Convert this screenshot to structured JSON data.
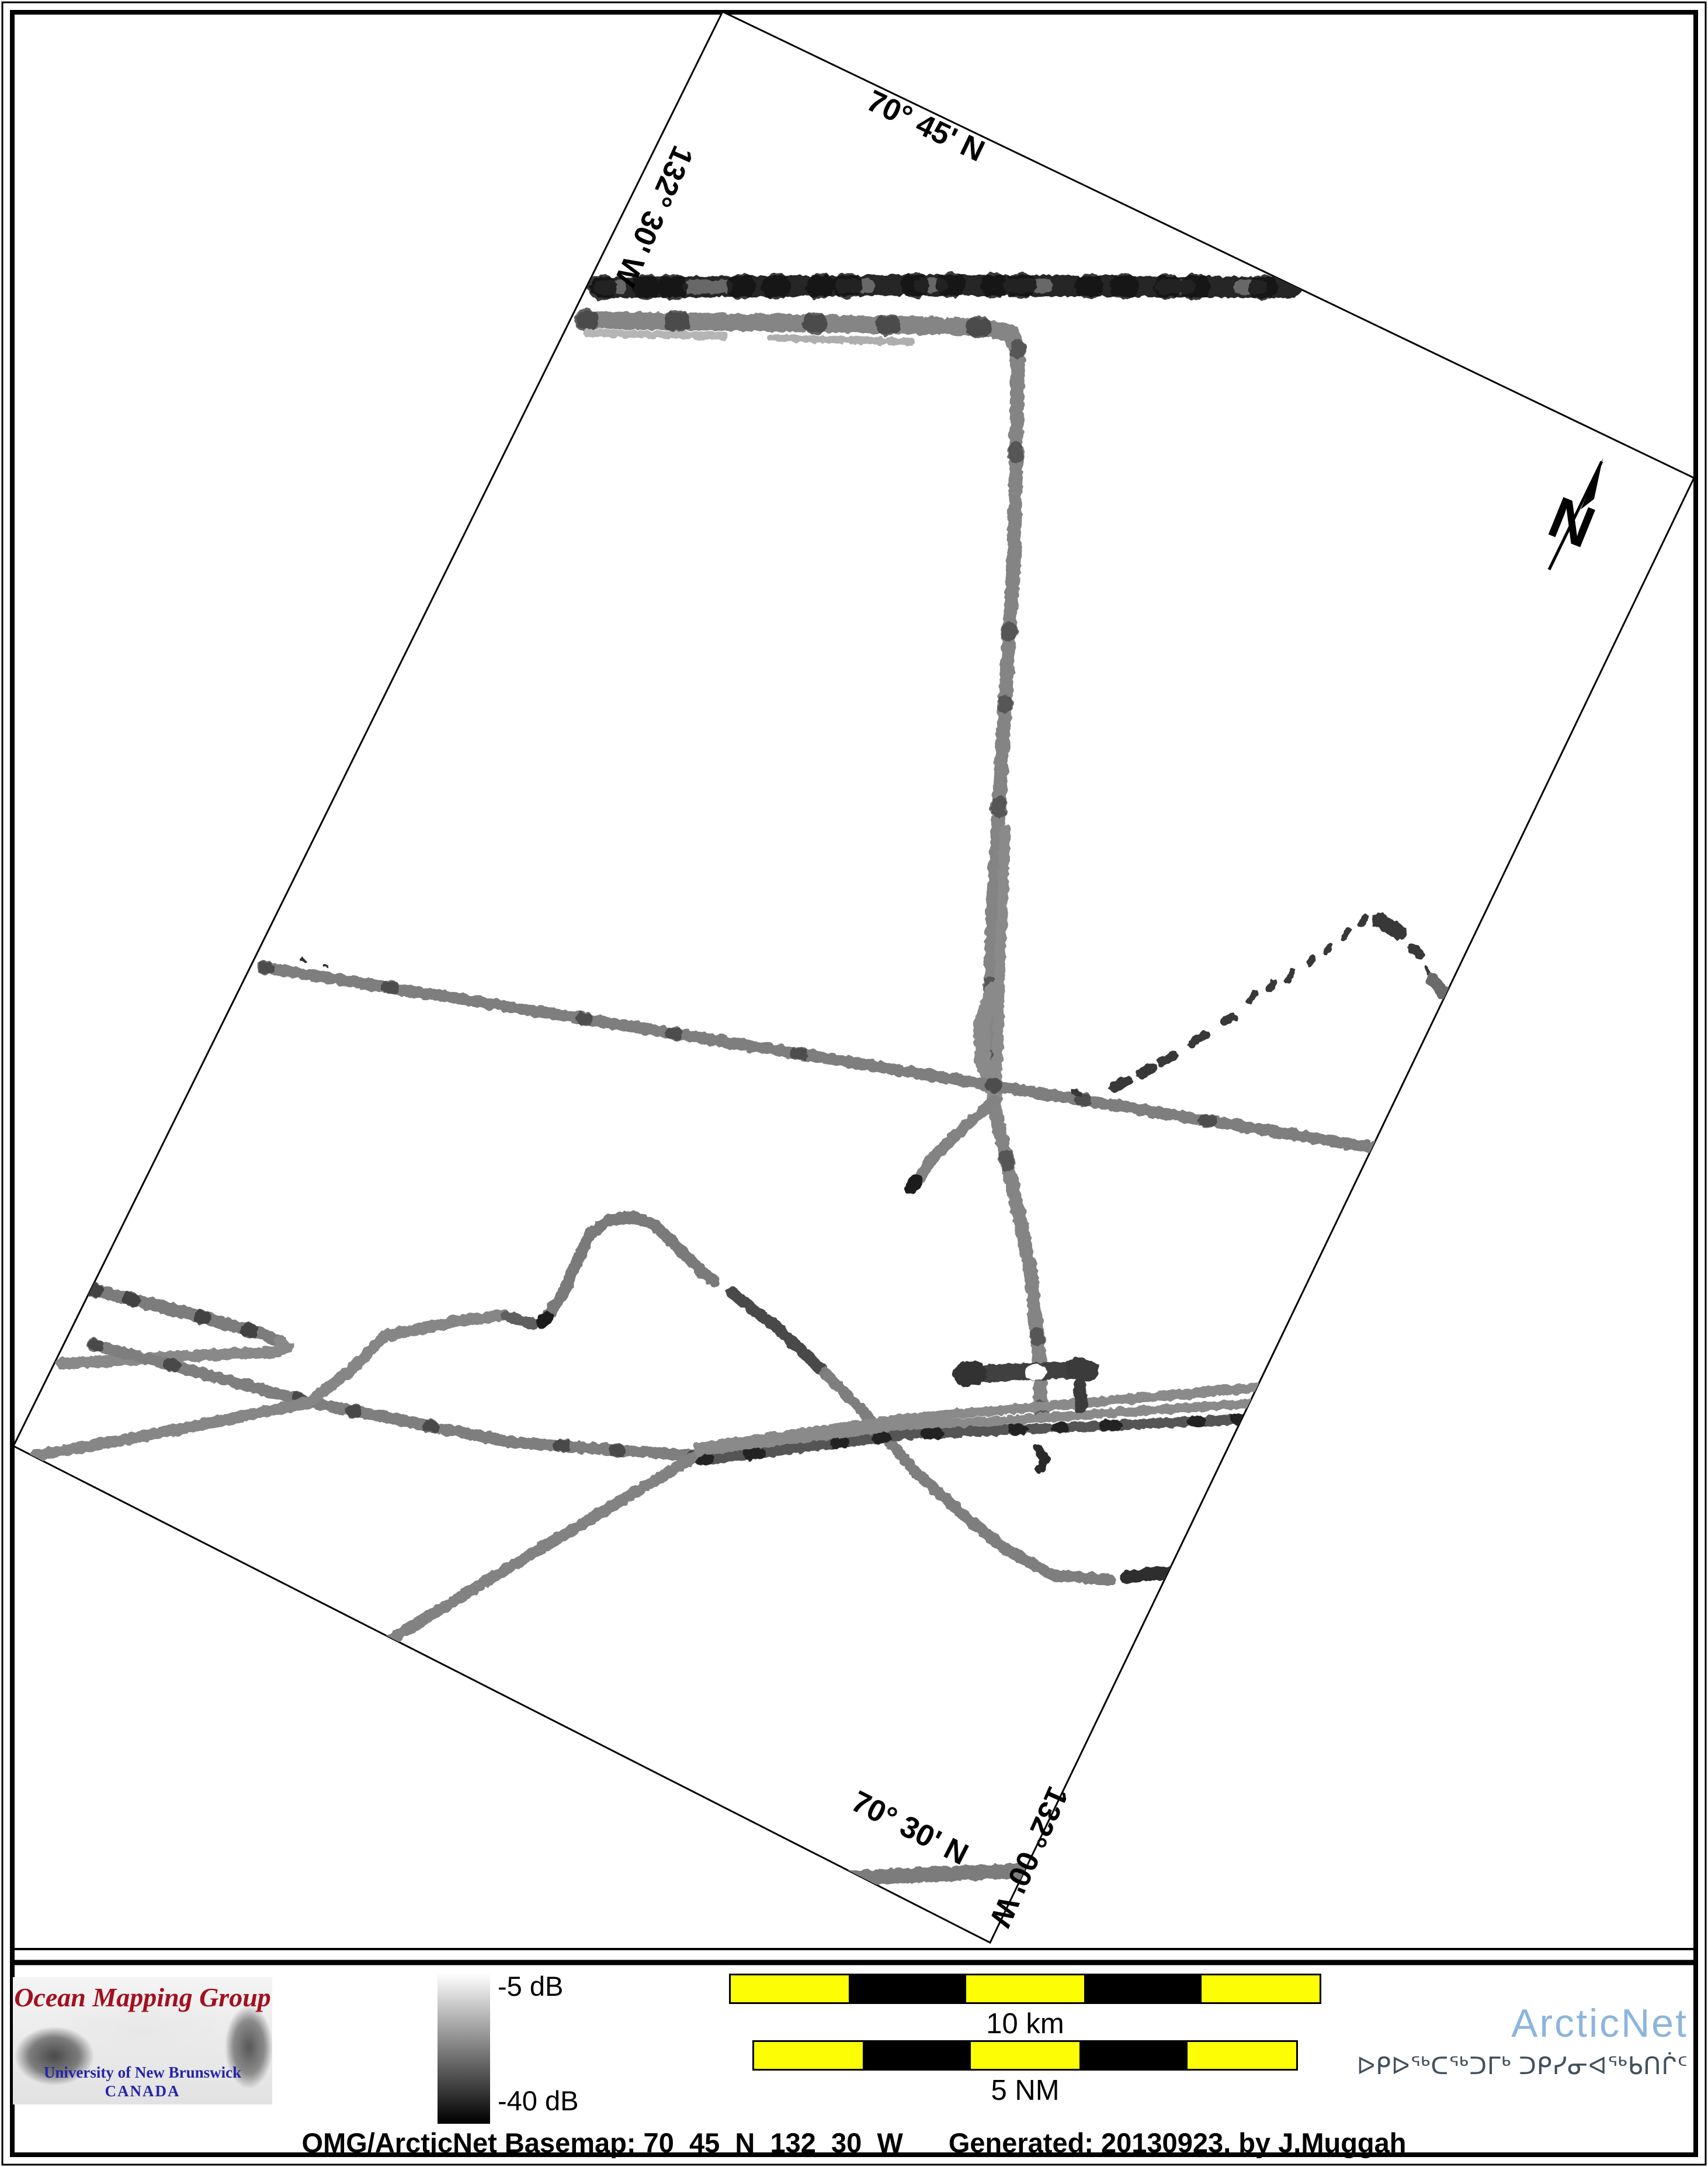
{
  "map": {
    "labels": {
      "lat_top": "70° 45' N",
      "lon_left": "132° 30' W",
      "lat_bottom": "70° 30' N",
      "lon_right": "132° 00' W"
    },
    "north_arrow": {
      "letter": "N"
    },
    "tracks": [
      {
        "name": "top-dark-band",
        "pts": [
          [
            1028,
            492
          ],
          [
            1620,
            488
          ],
          [
            2212,
            492
          ]
        ],
        "w": 36,
        "c": "#282828"
      },
      {
        "name": "top-dark-band-light-patches",
        "pts": [
          [
            1028,
            492
          ],
          [
            1620,
            488
          ],
          [
            2212,
            492
          ]
        ],
        "w": 24,
        "c": "#6e6e6e",
        "dash": "34 120 60 200 44 90",
        "o": 0.9
      },
      {
        "name": "top-dark-band-frays",
        "pts": [
          [
            1028,
            492
          ],
          [
            1620,
            488
          ],
          [
            2212,
            492
          ]
        ],
        "w": 44,
        "c": "#161616",
        "dash": "6 70 4 40 8 110 5 55",
        "o": 0.85
      },
      {
        "name": "top-gray-band",
        "pts": [
          [
            1002,
            548
          ],
          [
            1380,
            553
          ],
          [
            1688,
            560
          ],
          [
            1730,
            570
          ],
          [
            1743,
            600
          ]
        ],
        "w": 30,
        "c": "#858585"
      },
      {
        "name": "top-gray-band-ticks",
        "pts": [
          [
            1002,
            548
          ],
          [
            1380,
            553
          ],
          [
            1688,
            560
          ]
        ],
        "w": 38,
        "c": "#3c3c3c",
        "dash": "4 150 7 230 5 120",
        "o": 0.8
      },
      {
        "name": "top-gray-fringe-1",
        "pts": [
          [
            1005,
            570
          ],
          [
            1240,
            575
          ]
        ],
        "w": 13,
        "c": "#b5b5b5"
      },
      {
        "name": "top-gray-fringe-2",
        "pts": [
          [
            1320,
            578
          ],
          [
            1560,
            585
          ]
        ],
        "w": 13,
        "c": "#aeaeae"
      },
      {
        "name": "vertical-track",
        "pts": [
          [
            1743,
            595
          ],
          [
            1736,
            950
          ],
          [
            1718,
            1250
          ],
          [
            1700,
            1550
          ],
          [
            1694,
            1780
          ],
          [
            1704,
            1905
          ],
          [
            1734,
            2030
          ],
          [
            1765,
            2180
          ],
          [
            1779,
            2320
          ],
          [
            1782,
            2420
          ]
        ],
        "w": 24,
        "c": "#848484"
      },
      {
        "name": "vertical-track-ticks",
        "pts": [
          [
            1743,
            595
          ],
          [
            1736,
            950
          ],
          [
            1718,
            1250
          ],
          [
            1700,
            1550
          ],
          [
            1694,
            1780
          ],
          [
            1704,
            1905
          ],
          [
            1734,
            2030
          ],
          [
            1765,
            2180
          ],
          [
            1779,
            2320
          ],
          [
            1782,
            2420
          ]
        ],
        "w": 28,
        "c": "#454545",
        "dash": "5 170 9 300 4 120",
        "o": 0.7
      },
      {
        "name": "vertical-strand-2",
        "pts": [
          [
            1721,
            1420
          ],
          [
            1712,
            1640
          ],
          [
            1706,
            1865
          ]
        ],
        "w": 18,
        "c": "#8a8a8a"
      },
      {
        "name": "vertical-bulge",
        "pts": [
          [
            1700,
            1695
          ],
          [
            1680,
            1755
          ],
          [
            1683,
            1815
          ],
          [
            1702,
            1868
          ]
        ],
        "w": 28,
        "c": "#8a8a8a"
      },
      {
        "name": "branch-downleft",
        "pts": [
          [
            1702,
            1885
          ],
          [
            1652,
            1928
          ],
          [
            1598,
            1980
          ],
          [
            1572,
            2018
          ]
        ],
        "w": 20,
        "c": "#838383"
      },
      {
        "name": "branch-tip",
        "pts": [
          [
            1568,
            2022
          ],
          [
            1560,
            2032
          ]
        ],
        "w": 24,
        "c": "#1f1f1f"
      },
      {
        "name": "long-diagonal",
        "pts": [
          [
            452,
            1656
          ],
          [
            1100,
            1760
          ],
          [
            1700,
            1858
          ],
          [
            2349,
            1964
          ]
        ],
        "w": 20,
        "c": "#7e7e7e"
      },
      {
        "name": "long-diagonal-ticks",
        "pts": [
          [
            452,
            1656
          ],
          [
            1100,
            1760
          ],
          [
            1700,
            1858
          ],
          [
            2349,
            1964
          ]
        ],
        "w": 24,
        "c": "#3a3a3a",
        "dash": "5 210 8 330 6 150",
        "o": 0.7
      },
      {
        "name": "hairpin-upper",
        "pts": [
          [
            160,
            2208
          ],
          [
            330,
            2250
          ],
          [
            452,
            2284
          ],
          [
            480,
            2296
          ]
        ],
        "w": 22,
        "c": "#7c7c7c"
      },
      {
        "name": "hairpin-upper-ticks",
        "pts": [
          [
            160,
            2208
          ],
          [
            330,
            2250
          ],
          [
            452,
            2284
          ]
        ],
        "w": 26,
        "c": "#2f2f2f",
        "dash": "4 60 6 120 3 80",
        "o": 0.75
      },
      {
        "name": "hairpin-lower",
        "pts": [
          [
            480,
            2296
          ],
          [
            492,
            2306
          ],
          [
            474,
            2314
          ],
          [
            300,
            2322
          ],
          [
            106,
            2334
          ]
        ],
        "w": 20,
        "c": "#898989"
      },
      {
        "name": "line-a",
        "pts": [
          [
            162,
            2302
          ],
          [
            530,
            2400
          ],
          [
            872,
            2468
          ],
          [
            1030,
            2480
          ],
          [
            1192,
            2492
          ]
        ],
        "w": 20,
        "c": "#7e7e7e"
      },
      {
        "name": "line-a-ticks",
        "pts": [
          [
            162,
            2302
          ],
          [
            530,
            2400
          ],
          [
            872,
            2468
          ],
          [
            1030,
            2480
          ],
          [
            1192,
            2492
          ]
        ],
        "w": 24,
        "c": "#333333",
        "dash": "4 130 7 220 5 90",
        "o": 0.7
      },
      {
        "name": "line-b",
        "pts": [
          [
            60,
            2492
          ],
          [
            300,
            2448
          ],
          [
            530,
            2400
          ],
          [
            600,
            2345
          ],
          [
            660,
            2286
          ],
          [
            780,
            2262
          ],
          [
            864,
            2251
          ]
        ],
        "w": 20,
        "c": "#868686"
      },
      {
        "name": "line-b-dash",
        "pts": [
          [
            868,
            2253
          ],
          [
            914,
            2266
          ]
        ],
        "w": 20,
        "c": "#5f5f5f"
      },
      {
        "name": "hill-track",
        "pts": [
          [
            930,
            2262
          ],
          [
            962,
            2218
          ],
          [
            988,
            2160
          ],
          [
            1010,
            2112
          ],
          [
            1042,
            2088
          ],
          [
            1085,
            2083
          ],
          [
            1122,
            2097
          ],
          [
            1165,
            2140
          ],
          [
            1205,
            2180
          ],
          [
            1222,
            2194
          ]
        ],
        "w": 20,
        "c": "#7a7a7a"
      },
      {
        "name": "hill-start-tip",
        "pts": [
          [
            928,
            2262
          ],
          [
            936,
            2255
          ]
        ],
        "w": 22,
        "c": "#1f1f1f"
      },
      {
        "name": "hill-cont-dark",
        "pts": [
          [
            1252,
            2212
          ],
          [
            1330,
            2272
          ],
          [
            1412,
            2350
          ]
        ],
        "w": 20,
        "c": "#4a4a4a"
      },
      {
        "name": "hill-cont",
        "pts": [
          [
            1412,
            2350
          ],
          [
            1500,
            2440
          ],
          [
            1568,
            2520
          ],
          [
            1648,
            2592
          ],
          [
            1722,
            2652
          ],
          [
            1802,
            2696
          ],
          [
            1900,
            2704
          ]
        ],
        "w": 20,
        "c": "#7e7e7e"
      },
      {
        "name": "junction-branch",
        "pts": [
          [
            1192,
            2492
          ],
          [
            1000,
            2606
          ],
          [
            800,
            2726
          ],
          [
            662,
            2810
          ]
        ],
        "w": 20,
        "c": "#828282"
      },
      {
        "name": "bundle-strand-1",
        "pts": [
          [
            1196,
            2478
          ],
          [
            1550,
            2428
          ],
          [
            2152,
            2375
          ]
        ],
        "w": 17,
        "c": "#8a8a8a"
      },
      {
        "name": "bundle-strand-2",
        "pts": [
          [
            1198,
            2490
          ],
          [
            1550,
            2443
          ],
          [
            2139,
            2402
          ]
        ],
        "w": 16,
        "c": "#8a8a8a"
      },
      {
        "name": "bundle-strand-3",
        "pts": [
          [
            1200,
            2500
          ],
          [
            1550,
            2456
          ],
          [
            2126,
            2429
          ]
        ],
        "w": 17,
        "c": "#555555"
      },
      {
        "name": "bundle-strand-3-ticks",
        "pts": [
          [
            1200,
            2500
          ],
          [
            1550,
            2456
          ],
          [
            2126,
            2429
          ]
        ],
        "w": 19,
        "c": "#141414",
        "dash": "12 70 20 130 14 60",
        "o": 0.8
      },
      {
        "name": "t-bar",
        "pts": [
          [
            1658,
            2352
          ],
          [
            1782,
            2347
          ],
          [
            1858,
            2344
          ]
        ],
        "w": 30,
        "c": "#3f3f3f"
      },
      {
        "name": "t-bar-blob-left",
        "pts": [
          [
            1652,
            2352
          ],
          [
            1668,
            2350
          ]
        ],
        "w": 42,
        "c": "#333333"
      },
      {
        "name": "t-bar-blob-right",
        "pts": [
          [
            1844,
            2342
          ],
          [
            1862,
            2346
          ]
        ],
        "w": 38,
        "c": "#3a3a3a"
      },
      {
        "name": "t-bar-notch",
        "pts": [
          [
            1768,
            2349
          ],
          [
            1778,
            2348
          ]
        ],
        "w": 26,
        "c": "#ffffff"
      },
      {
        "name": "t-stub",
        "pts": [
          [
            1848,
            2372
          ],
          [
            1851,
            2408
          ]
        ],
        "w": 22,
        "c": "#3a3a3a"
      },
      {
        "name": "bundle-squiggle",
        "pts": [
          [
            1778,
            2480
          ],
          [
            1790,
            2498
          ],
          [
            1780,
            2515
          ]
        ],
        "w": 16,
        "c": "#2c2c2c"
      },
      {
        "name": "corner-line",
        "pts": [
          [
            1424,
            3216
          ],
          [
            1600,
            3208
          ],
          [
            1758,
            3202
          ]
        ],
        "w": 26,
        "c": "#7b7b7b"
      },
      {
        "name": "dark-short-segment",
        "pts": [
          [
            1928,
            2700
          ],
          [
            1980,
            2693
          ],
          [
            2042,
            2688
          ]
        ],
        "w": 22,
        "c": "#2d2d2d"
      },
      {
        "name": "dash-arc-01",
        "pts": [
          [
            1838,
            1868
          ],
          [
            1848,
            1872
          ]
        ],
        "w": 10,
        "c": "#383838"
      },
      {
        "name": "dash-arc-02",
        "pts": [
          [
            1908,
            1860
          ],
          [
            1930,
            1850
          ]
        ],
        "w": 18,
        "c": "#383838"
      },
      {
        "name": "dash-arc-03",
        "pts": [
          [
            1952,
            1838
          ],
          [
            1972,
            1828
          ]
        ],
        "w": 18,
        "c": "#383838"
      },
      {
        "name": "dash-arc-04",
        "pts": [
          [
            1988,
            1818
          ],
          [
            2010,
            1806
          ]
        ],
        "w": 16,
        "c": "#383838"
      },
      {
        "name": "dash-arc-05",
        "pts": [
          [
            2040,
            1786
          ],
          [
            2062,
            1772
          ]
        ],
        "w": 16,
        "c": "#383838"
      },
      {
        "name": "dash-arc-06",
        "pts": [
          [
            2096,
            1748
          ],
          [
            2112,
            1740
          ]
        ],
        "w": 14,
        "c": "#383838"
      },
      {
        "name": "dash-arc-07",
        "pts": [
          [
            2140,
            1712
          ],
          [
            2148,
            1700
          ]
        ],
        "w": 12,
        "c": "#383838"
      },
      {
        "name": "dash-arc-08",
        "pts": [
          [
            2172,
            1694
          ],
          [
            2180,
            1682
          ]
        ],
        "w": 12,
        "c": "#383838"
      },
      {
        "name": "dash-arc-09",
        "pts": [
          [
            2204,
            1678
          ],
          [
            2212,
            1664
          ]
        ],
        "w": 12,
        "c": "#383838"
      },
      {
        "name": "dash-arc-10",
        "pts": [
          [
            2242,
            1650
          ],
          [
            2248,
            1638
          ]
        ],
        "w": 10,
        "c": "#383838"
      },
      {
        "name": "dash-arc-11",
        "pts": [
          [
            2270,
            1630
          ],
          [
            2276,
            1618
          ]
        ],
        "w": 10,
        "c": "#383838"
      },
      {
        "name": "dash-arc-12",
        "pts": [
          [
            2300,
            1606
          ],
          [
            2308,
            1592
          ]
        ],
        "w": 10,
        "c": "#383838"
      },
      {
        "name": "dash-arc-13",
        "pts": [
          [
            2330,
            1582
          ],
          [
            2338,
            1568
          ]
        ],
        "w": 10,
        "c": "#383838"
      },
      {
        "name": "dash-arc-14",
        "pts": [
          [
            2362,
            1576
          ],
          [
            2396,
            1596
          ]
        ],
        "w": 26,
        "c": "#383838"
      },
      {
        "name": "dash-arc-15",
        "pts": [
          [
            2418,
            1622
          ],
          [
            2430,
            1634
          ]
        ],
        "w": 16,
        "c": "#383838"
      },
      {
        "name": "dash-arc-16",
        "pts": [
          [
            2442,
            1658
          ],
          [
            2446,
            1664
          ]
        ],
        "w": 8,
        "c": "#383838"
      },
      {
        "name": "dash-arc-17",
        "pts": [
          [
            2452,
            1676
          ],
          [
            2472,
            1700
          ]
        ],
        "w": 22,
        "c": "#6a6a6a"
      },
      {
        "name": "speck-1",
        "pts": [
          [
            516,
            1642
          ],
          [
            522,
            1646
          ]
        ],
        "w": 6,
        "c": "#333333"
      },
      {
        "name": "speck-2",
        "pts": [
          [
            556,
            1652
          ],
          [
            560,
            1655
          ]
        ],
        "w": 5,
        "c": "#333333"
      }
    ]
  },
  "footer": {
    "logo": {
      "title": "Ocean Mapping Group",
      "subtitle": "University of New Brunswick",
      "country": "CANADA"
    },
    "colorbar": {
      "top_label": "-5 dB",
      "bottom_label": "-40 dB",
      "top_color": "#ffffff",
      "bottom_color": "#000000"
    },
    "scalebars": [
      {
        "label": "10 km",
        "segment_colors": [
          "#fdfd05",
          "#000000",
          "#fdfd05",
          "#000000",
          "#fdfd05"
        ]
      },
      {
        "label": "5 NM",
        "segment_colors": [
          "#fdfd05",
          "#000000",
          "#fdfd05",
          "#000000",
          "#fdfd05"
        ]
      }
    ],
    "arcticnet": {
      "name": "ArcticNet",
      "name_color": "#8cb5dd",
      "inuktitut": "ᐅᑭᐅᖅᑕᖅᑐᒥᒃ ᑐᑭᓯᓂᐊᖅᑲᑎᒌᑦ"
    },
    "caption": {
      "left": "OMG/ArcticNet Basemap: 70_45_N_132_30_W",
      "right": "Generated: 20130923, by J.Muggah"
    }
  }
}
